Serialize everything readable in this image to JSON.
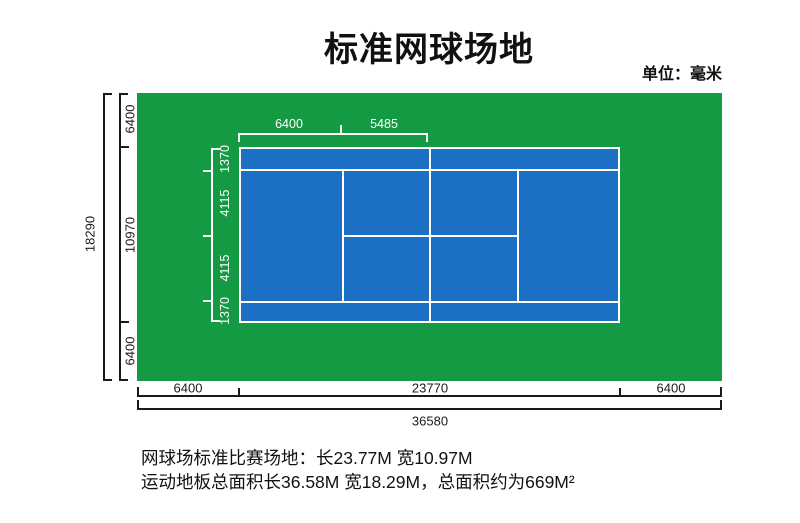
{
  "page": {
    "title": "标准网球场地",
    "unit_label": "单位：毫米"
  },
  "colors": {
    "surround_green": "#159a44",
    "court_blue": "#1c70c4",
    "line_white": "#ffffff",
    "dim_black": "#1a1a1a"
  },
  "dimensions": {
    "top_half_court": {
      "baseline_to_serviceline": "6400",
      "serviceline_to_net": "5485"
    },
    "court_width_left": {
      "alley_top": "1370",
      "half_singles_top": "4115",
      "half_singles_bottom": "4115",
      "alley_bottom": "1370"
    },
    "site_width_left": {
      "margin_top": "6400",
      "court_width": "10970",
      "margin_bottom": "6400",
      "total": "18290"
    },
    "site_length_bottom": {
      "margin_left": "6400",
      "court_length": "23770",
      "margin_right": "6400",
      "total": "36580"
    }
  },
  "caption": {
    "line1": "网球场标准比赛场地：长23.77M 宽10.97M",
    "line2": "运动地板总面积长36.58M 宽18.29M，总面积约为669M²"
  }
}
